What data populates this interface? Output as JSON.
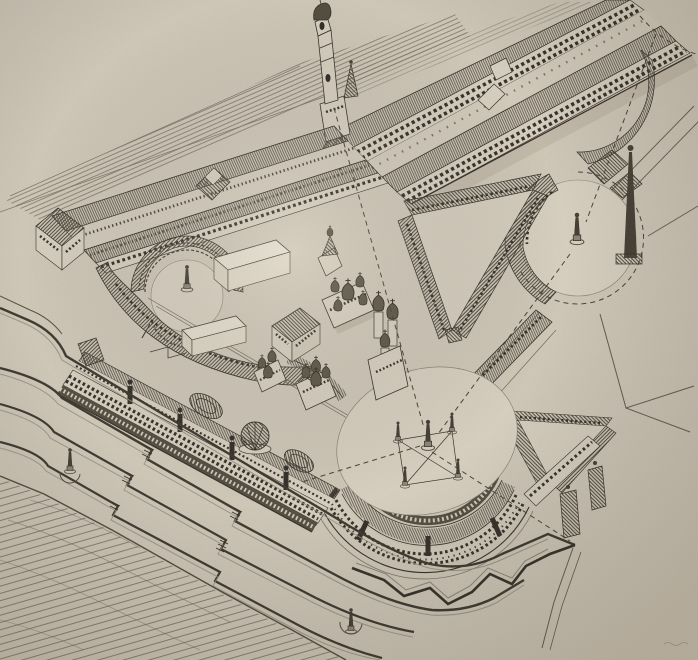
{
  "figure": {
    "kind": "engraved bird's-eye architectural perspective",
    "subject": "Aerial view of a vast neoclassical palace-fortress complex with triangular and oval forecourts, circular plazas with obelisks, a cluster of onion-domed cathedrals inside the courtyard, long wings, bastioned ramparts and a stepped river embankment",
    "visible_text": ""
  },
  "palette": {
    "paper": "#d5cdbe",
    "paper_light": "#ded6c7",
    "plaza": "#dcd4c5",
    "courtyard": "#d9d1c2",
    "wall_light": "#ddd5c6",
    "ink": "#29241e",
    "ink_soft": "#4e473b",
    "hatch": "#454035",
    "fine_hatch": "#4a443a",
    "streak": "#6f6759",
    "water": "#6e6557",
    "dash": "#3f392e",
    "white_top": "#ece6d8",
    "white_side": "#dfd8c7",
    "dome": "#554d3e",
    "shadow": "#a89d8a",
    "highlight": "#948b7b",
    "colonnade": "#4c4539"
  },
  "scene": {
    "landmarks": [
      "bell-tower",
      "north-range",
      "west-courtyard-block",
      "amphitheater-court",
      "curved-gallery",
      "triangular-court",
      "small-triangular-court",
      "circular-plaza",
      "tall-obelisk",
      "oval-plaza",
      "five-obelisk-group",
      "cathedral-cluster",
      "faceted-palace",
      "white-service-blocks",
      "south-facade",
      "central-dome",
      "oval-roof-halls",
      "hemicycle",
      "bastion-rampart",
      "embankment-terraces",
      "river",
      "sight-lines",
      "embankment-obelisks"
    ]
  }
}
